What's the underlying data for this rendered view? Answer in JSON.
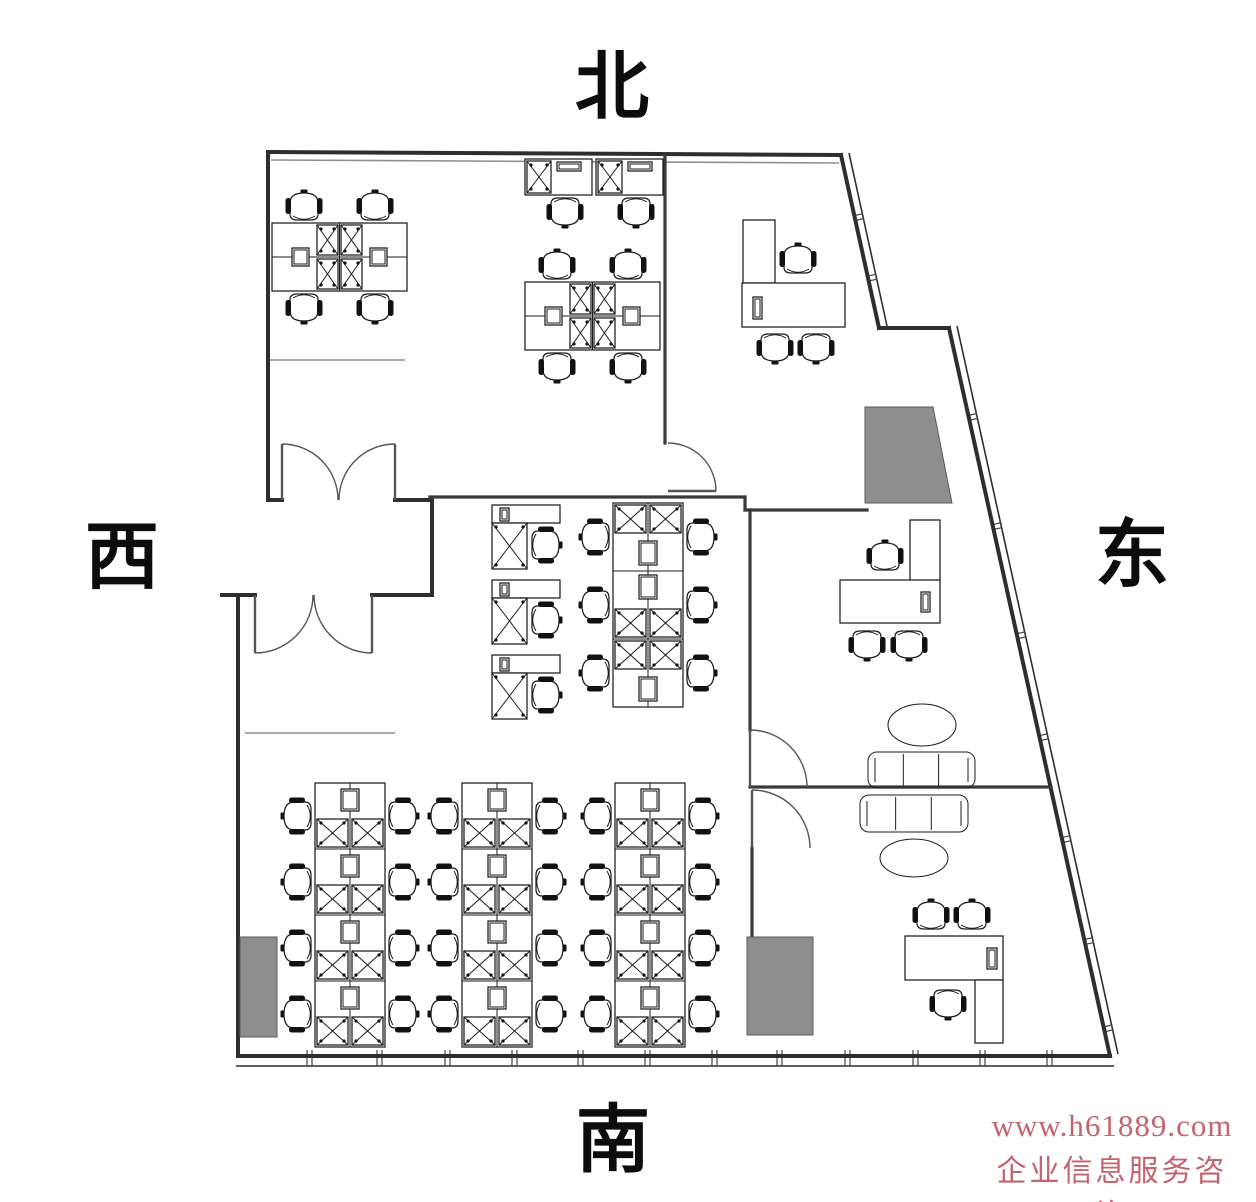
{
  "title": "office floor plan",
  "compass": {
    "north": "北",
    "south": "南",
    "west": "西",
    "east": "东",
    "positions": {
      "north": [
        612,
        88
      ],
      "south": [
        613,
        1141
      ],
      "west": [
        122,
        558
      ],
      "east": [
        1132,
        556
      ]
    }
  },
  "watermark": {
    "line1": "www.h61889.com",
    "line2": "企业信息服务咨询",
    "color": "#c4646e",
    "position": [
      1112,
      1108
    ]
  },
  "colors": {
    "wall": "#2e2e2e",
    "furniture": "#1c1c1c",
    "column_fill": "#8e8e8e",
    "background": "#ffffff"
  },
  "plan": {
    "width": 1256,
    "height": 1202,
    "outer_walls": [
      [
        268,
        152,
        841,
        155
      ],
      [
        841,
        155,
        879,
        328
      ],
      [
        879,
        328,
        949,
        328
      ],
      [
        949,
        328,
        1110,
        1056
      ],
      [
        1110,
        1056,
        238,
        1056
      ],
      [
        238,
        1056,
        238,
        595
      ],
      [
        222,
        595,
        255,
        595
      ],
      [
        372,
        595,
        432,
        595
      ],
      [
        432,
        595,
        432,
        500
      ],
      [
        432,
        500,
        395,
        500
      ],
      [
        282,
        500,
        268,
        500
      ],
      [
        268,
        500,
        268,
        152
      ]
    ],
    "inner_walls": [
      [
        430,
        497,
        745,
        497
      ],
      [
        745,
        497,
        745,
        510
      ],
      [
        745,
        510,
        867,
        510
      ],
      [
        665,
        155,
        665,
        443
      ],
      [
        750,
        510,
        750,
        730
      ],
      [
        750,
        787,
        1051,
        787
      ],
      [
        752,
        848,
        752,
        937
      ]
    ],
    "thin_lines": [
      [
        268,
        360,
        405,
        360
      ],
      [
        245,
        733,
        395,
        733
      ],
      [
        271,
        160,
        839,
        163
      ]
    ],
    "windows": {
      "south": {
        "outer": [
          236,
          1066,
          1114,
          1066
        ],
        "ticks": [
          307,
          377,
          445,
          512,
          578,
          645,
          712,
          777,
          845,
          913,
          980,
          1047
        ]
      },
      "east": {
        "outer": [
          957,
          326,
          1118,
          1054
        ],
        "base": [
          949,
          328,
          1110,
          1056
        ],
        "ticks": [
          0.12,
          0.27,
          0.42,
          0.56,
          0.7,
          0.84,
          0.96
        ]
      },
      "ne": {
        "outer": [
          849,
          153,
          887,
          326
        ],
        "base": [
          841,
          155,
          879,
          328
        ],
        "ticks": [
          0.35,
          0.7
        ]
      }
    },
    "doors": [
      {
        "leaf": [
          282,
          500,
          282,
          444
        ],
        "arc": [
          282,
          444,
          338,
          500,
          56,
          1
        ]
      },
      {
        "leaf": [
          395,
          500,
          395,
          444
        ],
        "arc": [
          395,
          444,
          339,
          500,
          56,
          0
        ]
      },
      {
        "leaf": [
          255,
          595,
          255,
          653
        ],
        "arc": [
          255,
          653,
          313,
          595,
          58,
          0
        ]
      },
      {
        "leaf": [
          372,
          595,
          372,
          653
        ],
        "arc": [
          372,
          653,
          314,
          595,
          58,
          1
        ]
      },
      {
        "leaf": [
          668,
          491,
          716,
          491
        ],
        "arc": [
          668,
          443,
          716,
          491,
          48,
          1
        ]
      },
      {
        "leaf": [
          750,
          787,
          750,
          730
        ],
        "arc": [
          750,
          730,
          807,
          787,
          57,
          1
        ]
      },
      {
        "leaf": [
          752,
          848,
          752,
          790
        ],
        "arc": [
          752,
          790,
          810,
          848,
          58,
          1
        ]
      }
    ],
    "columns": [
      [
        865,
        407,
        933,
        407,
        952,
        503,
        865,
        503
      ],
      [
        240,
        937,
        277,
        937,
        277,
        1037,
        240,
        1037
      ],
      [
        747,
        937,
        813,
        937,
        813,
        1035,
        747,
        1035
      ]
    ],
    "furniture": {
      "quad_pods": [
        [
          272,
          223
        ],
        [
          525,
          282
        ]
      ],
      "pair_desks": [
        [
          525,
          159
        ]
      ],
      "single_desks": [
        [
          492,
          505
        ],
        [
          492,
          580
        ],
        [
          492,
          655
        ]
      ],
      "pods_2x3": [
        [
          613,
          503
        ]
      ],
      "pods_2x4": [
        [
          315,
          783
        ],
        [
          462,
          783
        ],
        [
          615,
          783
        ]
      ],
      "desks": [
        [
          743,
          220,
          32,
          63
        ],
        [
          742,
          283,
          103,
          44
        ],
        [
          910,
          520,
          30,
          63
        ],
        [
          840,
          580,
          100,
          43
        ],
        [
          905,
          936,
          98,
          44
        ],
        [
          975,
          980,
          28,
          63
        ]
      ],
      "monitors": [
        [
          753,
          297,
          9,
          22
        ],
        [
          921,
          592,
          9,
          20
        ],
        [
          987,
          948,
          10,
          21
        ]
      ],
      "chairs": [
        [
          798,
          260,
          0
        ],
        [
          775,
          347,
          180
        ],
        [
          816,
          347,
          180
        ],
        [
          885,
          557,
          0
        ],
        [
          867,
          644,
          180
        ],
        [
          909,
          644,
          180
        ],
        [
          931,
          916,
          0
        ],
        [
          972,
          916,
          0
        ],
        [
          948,
          1003,
          180
        ]
      ],
      "sofas": [
        [
          868,
          752,
          107,
          36
        ],
        [
          860,
          795,
          108,
          37
        ]
      ],
      "ovals": [
        [
          922,
          725,
          34,
          21
        ],
        [
          914,
          858,
          34,
          19
        ]
      ]
    }
  }
}
